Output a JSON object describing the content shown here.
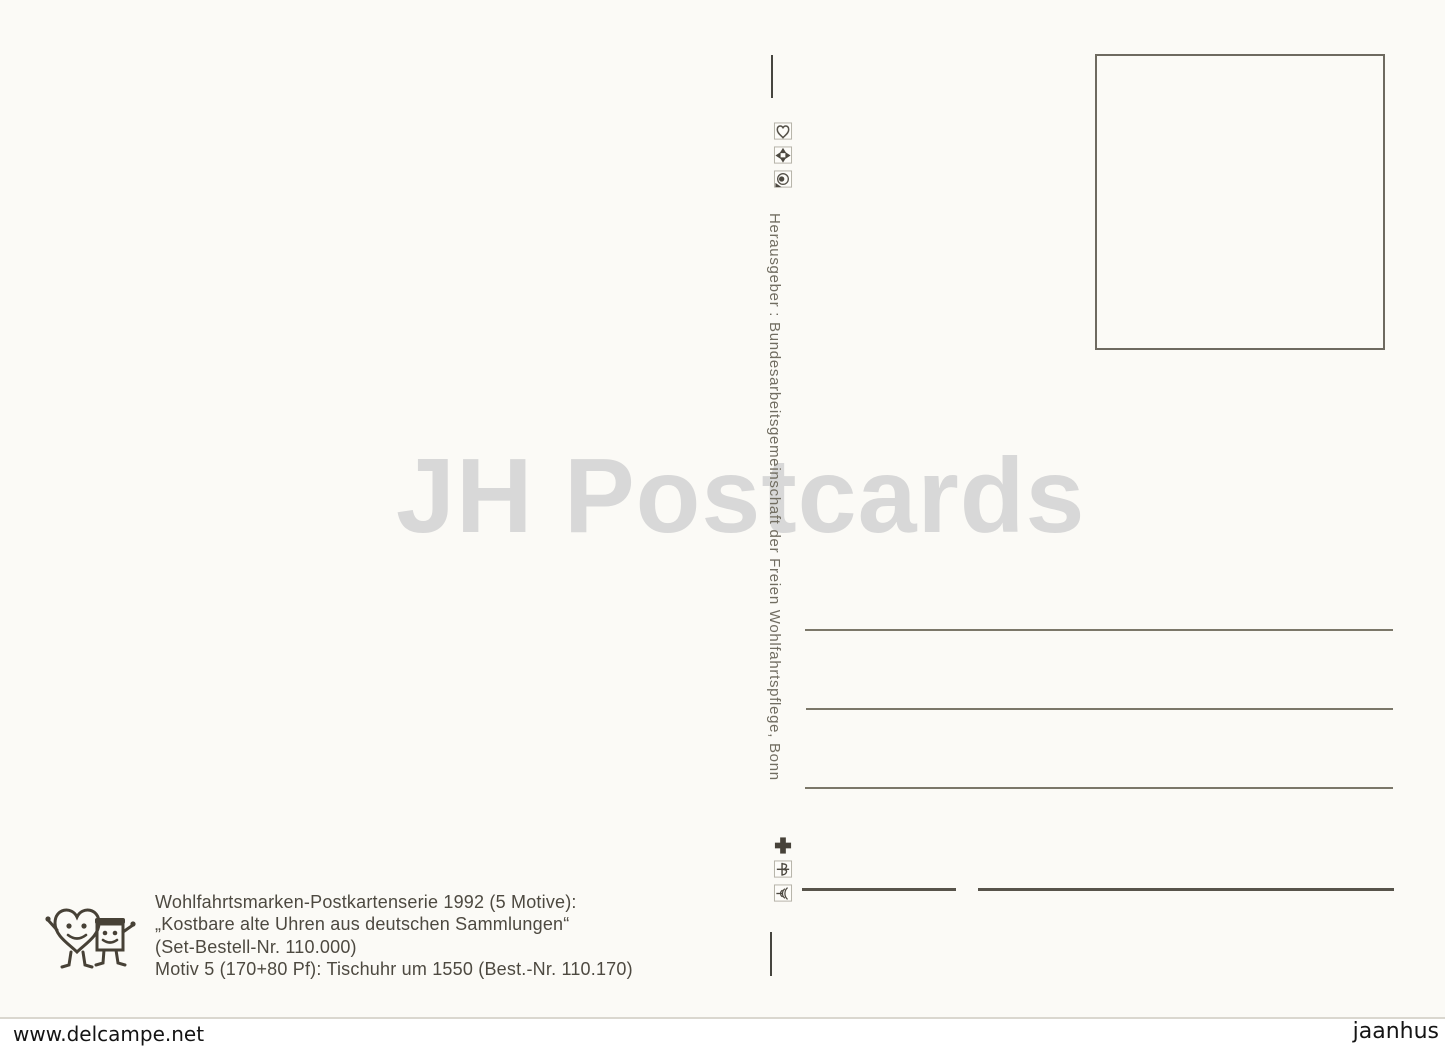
{
  "postcard": {
    "watermark_text": "JH Postcards",
    "publisher_vertical_text": "Herausgeber : Bundesarbeitsgemeinschaft der Freien Wohlfahrtspflege, Bonn",
    "charity_icons_top": [
      "heart-charity-logo",
      "arrow-cross-charity-logo",
      "eye-circle-charity-logo"
    ],
    "charity_icons_bottom": [
      "red-cross-charity-logo",
      "crown-cross-charity-logo",
      "menorah-charity-logo"
    ],
    "imprint": {
      "series_line": "Wohlfahrtsmarken-Postkartenserie 1992 (5 Motive):",
      "title_line": "„Kostbare alte Uhren aus deutschen Sammlungen“",
      "set_line": "(Set-Bestell-Nr. 110.000)",
      "motif_line": "Motiv 5 (170+80 Pf): Tischuhr um 1550 (Best.-Nr. 110.170)"
    },
    "address_line_count": 4,
    "stamp_box_content": ""
  },
  "overlay": {
    "site_left": "www.delcampe.net",
    "site_right": "jaanhus"
  },
  "colors": {
    "postcard_bg": "#fbfaf6",
    "ink": "#4d4940",
    "line_gray": "#7b7769",
    "watermark_gray": "#d8d8d8"
  }
}
